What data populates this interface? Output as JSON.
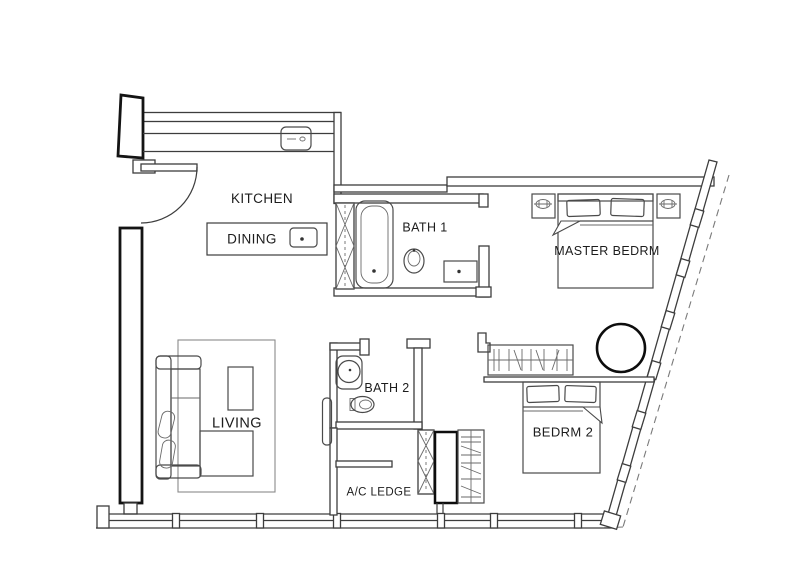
{
  "floor_plan": {
    "background": "#ffffff",
    "line_color": "#3d3d3d",
    "wall_color": "#141414",
    "rooms": {
      "kitchen": "KITCHEN",
      "dining": "DINING",
      "bath1": "BATH 1",
      "master_bedroom": "MASTER BEDRM",
      "bath2": "BATH 2",
      "living": "LIVING",
      "bedroom2": "BEDRM 2",
      "ac_ledge": "A/C LEDGE"
    }
  }
}
